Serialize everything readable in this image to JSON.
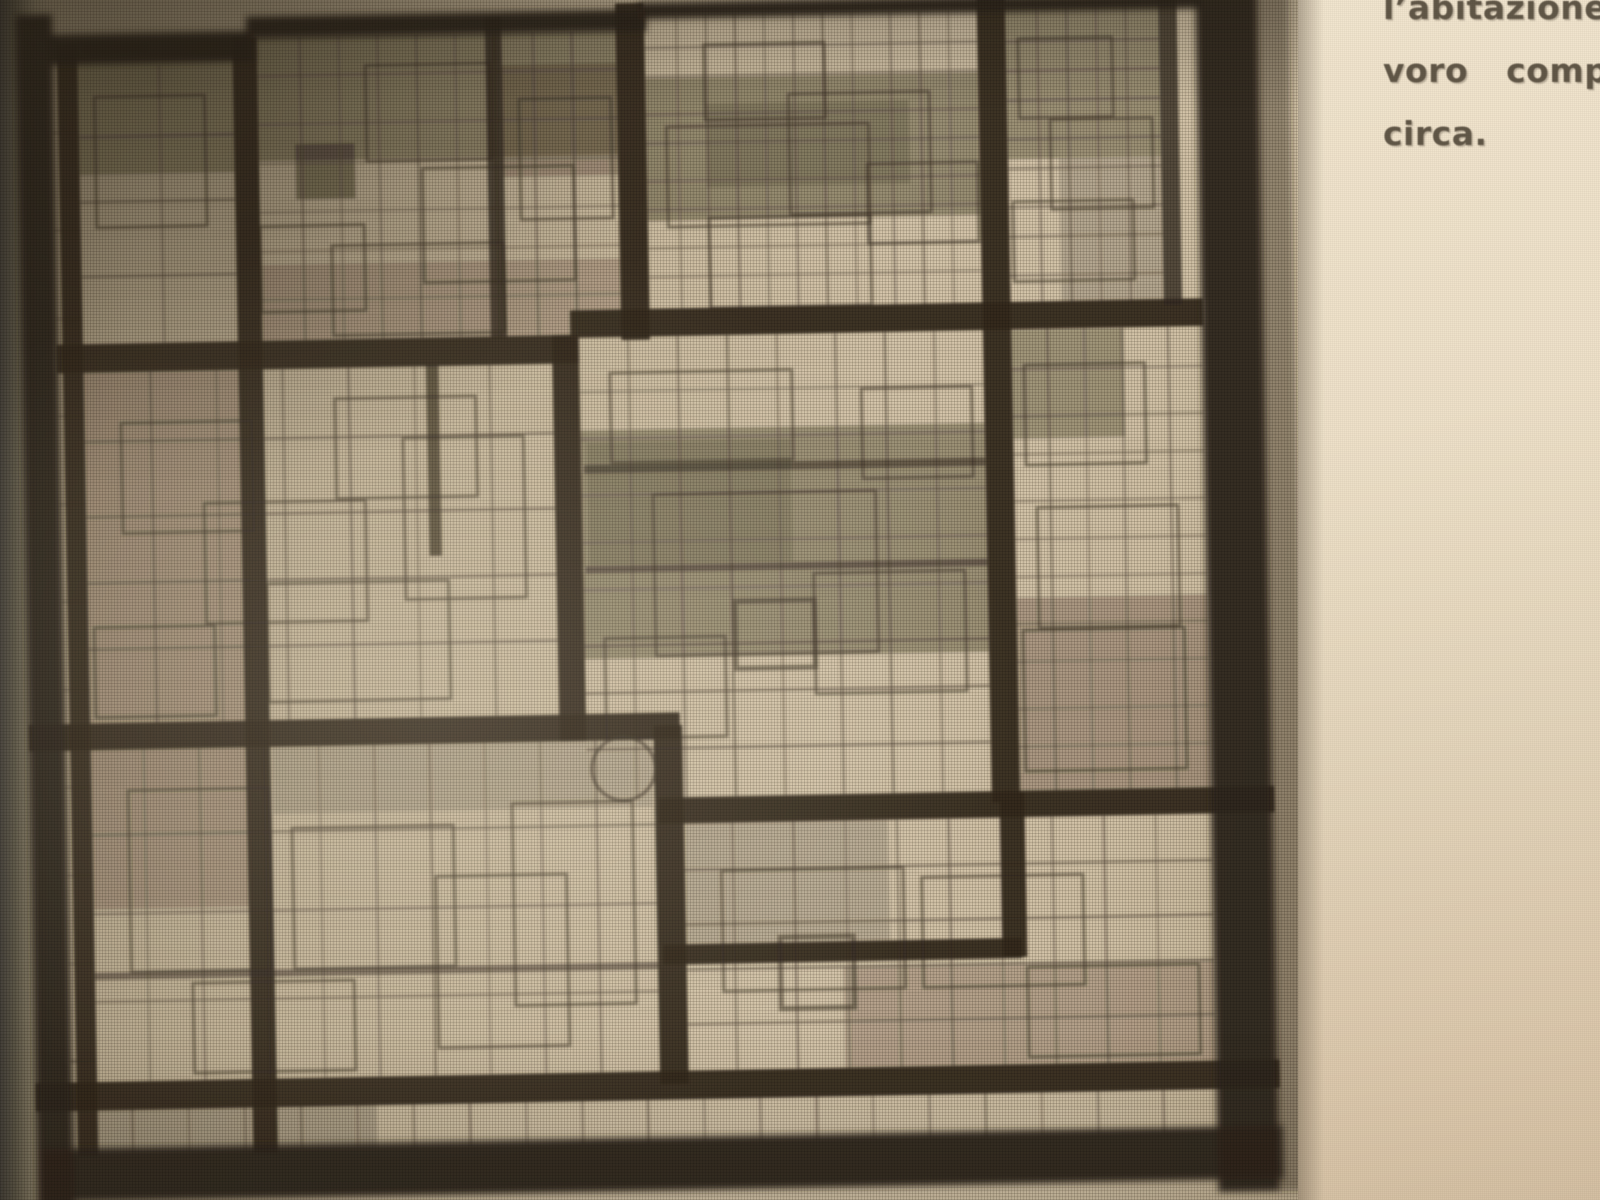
{
  "caption": {
    "lines": [
      "l’abitazione",
      "voro comp",
      "circa."
    ],
    "text_color": "#615747"
  },
  "figure": {
    "kind": "halftone print of a rectilinear grid composition (architectural plan/facade)",
    "colors": {
      "frame": "#31281d",
      "heavy": "#362c20",
      "line": "#453a2c",
      "thin": "#55483a",
      "patch": "#1e160c"
    },
    "frame": [
      [
        26,
        0,
        36,
        1176
      ],
      [
        1183,
        0,
        60,
        1176
      ],
      [
        1240,
        0,
        34,
        1176,
        0.38
      ],
      [
        26,
        1112,
        1221,
        52
      ],
      [
        60,
        20,
        200,
        30
      ],
      [
        252,
        6,
        392,
        22
      ],
      [
        636,
        0,
        551,
        16
      ]
    ],
    "heavy": [
      [
        66,
        30,
        20,
        1090
      ],
      [
        238,
        26,
        24,
        1094
      ],
      [
        614,
        0,
        28,
        330
      ],
      [
        546,
        324,
        26,
        398
      ],
      [
        638,
        708,
        28,
        352
      ],
      [
        968,
        0,
        28,
        790
      ],
      [
        976,
        780,
        24,
        162
      ],
      [
        60,
        324,
        512,
        28
      ],
      [
        564,
        300,
        621,
        27
      ],
      [
        26,
        696,
        638,
        26
      ],
      [
        641,
        779,
        604,
        26
      ],
      [
        26,
        1047,
        1219,
        28
      ],
      [
        643,
        923,
        352,
        20
      ],
      [
        1146,
        0,
        18,
        306,
        0.8
      ],
      [
        486,
        12,
        16,
        314,
        0.8
      ],
      [
        422,
        350,
        12,
        188,
        0.7
      ],
      [
        575,
        452,
        393,
        8,
        0.55
      ],
      [
        575,
        551,
        393,
        7,
        0.5
      ],
      [
        86,
        940,
        552,
        7,
        0.5
      ]
    ],
    "panels": [
      [
        86,
        52,
        152,
        272,
        2,
        4
      ],
      [
        262,
        26,
        352,
        298,
        9,
        7
      ],
      [
        642,
        12,
        326,
        290,
        11,
        9
      ],
      [
        996,
        8,
        150,
        296,
        5,
        9
      ],
      [
        86,
        352,
        460,
        344,
        7,
        5
      ],
      [
        572,
        327,
        396,
        452,
        8,
        9
      ],
      [
        996,
        327,
        187,
        452,
        5,
        11
      ],
      [
        86,
        722,
        552,
        325,
        10,
        4
      ],
      [
        666,
        805,
        517,
        242,
        10,
        5
      ],
      [
        60,
        1073,
        1123,
        45,
        20,
        1
      ],
      [
        60,
        30,
        26,
        1086,
        1,
        12
      ]
    ],
    "rects": [
      [
        368,
        56,
        122,
        94
      ],
      [
        422,
        158,
        148,
        112
      ],
      [
        262,
        212,
        102,
        84
      ],
      [
        332,
        232,
        168,
        88
      ],
      [
        518,
        92,
        90,
        118
      ],
      [
        700,
        42,
        118,
        74
      ],
      [
        662,
        122,
        198,
        98
      ],
      [
        782,
        92,
        138,
        118
      ],
      [
        858,
        162,
        108,
        78
      ],
      [
        702,
        212,
        158,
        88
      ],
      [
        1008,
        42,
        92,
        78
      ],
      [
        1038,
        122,
        100,
        88
      ],
      [
        1000,
        202,
        118,
        78
      ],
      [
        122,
        402,
        128,
        108
      ],
      [
        202,
        482,
        158,
        118
      ],
      [
        332,
        382,
        138,
        98
      ],
      [
        262,
        562,
        178,
        116
      ],
      [
        92,
        602,
        118,
        88
      ],
      [
        398,
        422,
        118,
        158
      ],
      [
        602,
        362,
        178,
        88
      ],
      [
        642,
        482,
        218,
        158
      ],
      [
        798,
        562,
        148,
        118
      ],
      [
        592,
        622,
        118,
        98
      ],
      [
        848,
        382,
        108,
        88
      ],
      [
        720,
        588,
        78,
        66,
        5
      ],
      [
        1008,
        362,
        118,
        98
      ],
      [
        1018,
        502,
        138,
        118
      ],
      [
        1002,
        622,
        158,
        138
      ],
      [
        122,
        762,
        138,
        178
      ],
      [
        282,
        802,
        158,
        138
      ],
      [
        422,
        852,
        128,
        168
      ],
      [
        182,
        952,
        158,
        88
      ],
      [
        498,
        782,
        118,
        198
      ],
      [
        702,
        852,
        178,
        118
      ],
      [
        758,
        918,
        72,
        70,
        5
      ],
      [
        898,
        862,
        158,
        108
      ],
      [
        1000,
        952,
        168,
        88
      ],
      [
        102,
        82,
        108,
        128
      ]
    ],
    "patches": [
      [
        262,
        26,
        352,
        122,
        0.3
      ],
      [
        298,
        132,
        58,
        54,
        0.38
      ],
      [
        500,
        58,
        114,
        110,
        0.22
      ],
      [
        642,
        74,
        326,
        140,
        0.32
      ],
      [
        700,
        100,
        200,
        82,
        0.14
      ],
      [
        996,
        8,
        150,
        152,
        0.3
      ],
      [
        1046,
        160,
        100,
        140,
        0.14
      ],
      [
        86,
        28,
        152,
        130,
        0.28
      ],
      [
        262,
        250,
        352,
        74,
        0.16
      ],
      [
        572,
        418,
        396,
        224,
        0.3
      ],
      [
        578,
        430,
        200,
        120,
        0.12
      ],
      [
        996,
        328,
        110,
        106,
        0.28
      ],
      [
        996,
        590,
        187,
        190,
        0.22
      ],
      [
        86,
        352,
        160,
        344,
        0.16
      ],
      [
        86,
        722,
        156,
        156,
        0.18
      ],
      [
        264,
        722,
        372,
        66,
        0.12
      ],
      [
        666,
        805,
        200,
        118,
        0.13
      ],
      [
        820,
        948,
        363,
        99,
        0.17
      ],
      [
        60,
        1073,
        300,
        45,
        0.14
      ],
      [
        92,
        30,
        64,
        9,
        0.5
      ]
    ],
    "circle": {
      "cx": 608,
      "cy": 750,
      "r": 31
    }
  }
}
